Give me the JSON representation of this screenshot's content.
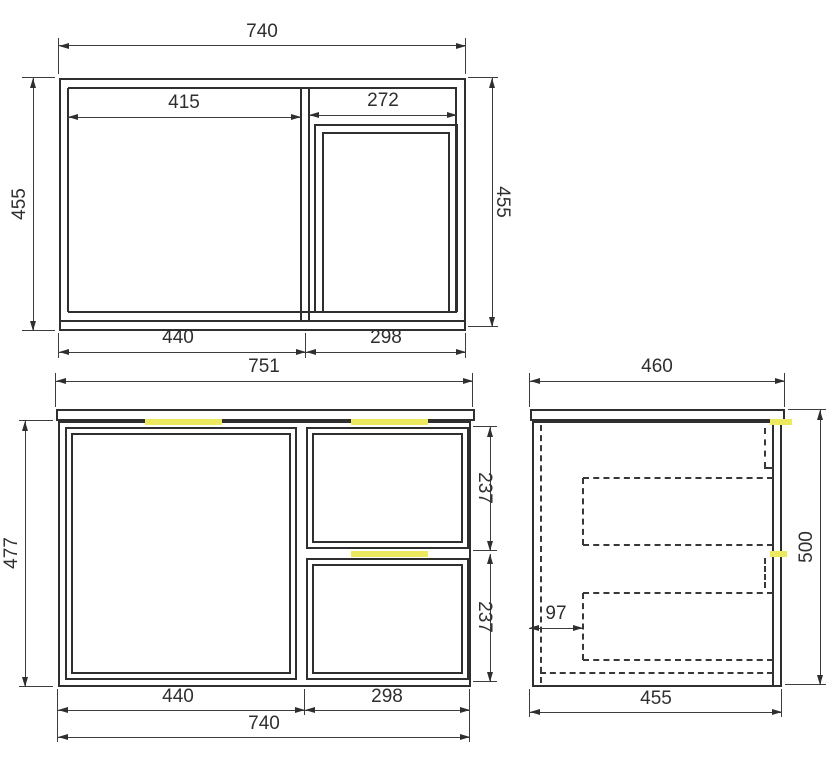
{
  "colors": {
    "line": "#2f2f2f",
    "highlight": "#ece95f",
    "background": "#ffffff"
  },
  "views": {
    "top": {
      "dims": {
        "overall_width": "740",
        "left_opening": "415",
        "right_opening": "272",
        "depth_left": "455",
        "depth_right": "455",
        "bottom_left": "440",
        "bottom_right": "298"
      }
    },
    "front": {
      "dims": {
        "benchtop_width": "751",
        "cabinet_height": "477",
        "top_drawer_height": "237",
        "bottom_drawer_height": "237",
        "door_section_width": "440",
        "drawer_section_width": "298",
        "cabinet_width": "740"
      }
    },
    "side": {
      "dims": {
        "benchtop_depth": "460",
        "drawer_inset": "97",
        "overall_height": "500",
        "cabinet_depth": "455"
      }
    }
  }
}
